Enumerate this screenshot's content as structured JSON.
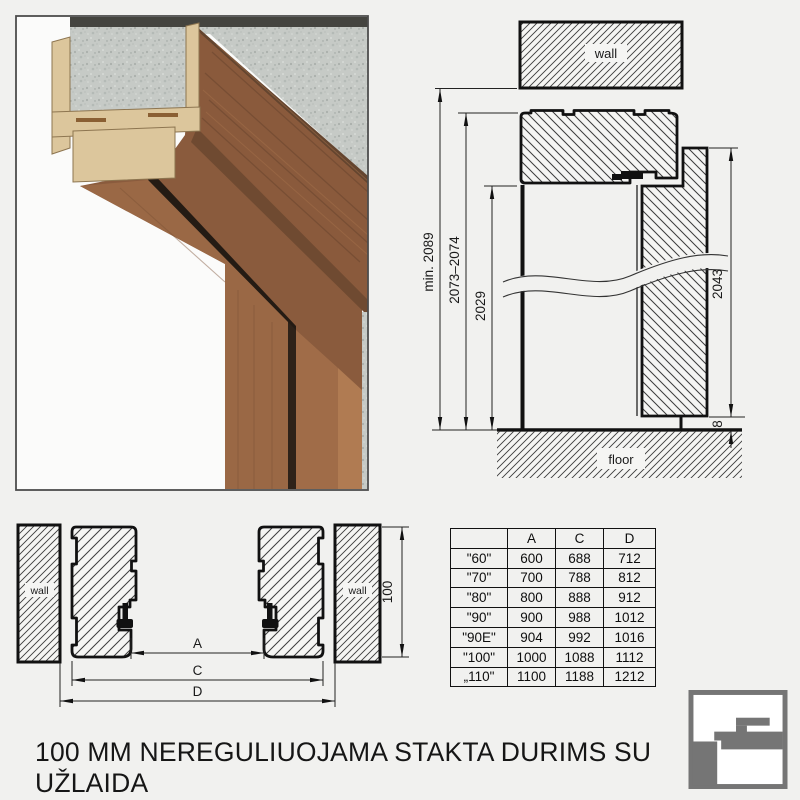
{
  "title": "100 MM NEREGULIUOJAMA STAKTA DURIMS SU UŽLAIDA",
  "vertical_section": {
    "wall_label": "wall",
    "floor_label": "floor",
    "dim_total": "min. 2089",
    "dim_frame": "2073–2074",
    "dim_opening": "2029",
    "dim_leaf": "2043",
    "dim_gap": "8"
  },
  "horizontal_section": {
    "wall_left": "wall",
    "wall_right": "wall",
    "dim_depth": "100",
    "dim_a": "A",
    "dim_c": "C",
    "dim_d": "D"
  },
  "table": {
    "headers": [
      "",
      "A",
      "C",
      "D"
    ],
    "rows": [
      [
        "\"60\"",
        "600",
        "688",
        "712"
      ],
      [
        "\"70\"",
        "700",
        "788",
        "812"
      ],
      [
        "\"80\"",
        "800",
        "888",
        "912"
      ],
      [
        "\"90\"",
        "900",
        "988",
        "1012"
      ],
      [
        "\"90E\"",
        "904",
        "992",
        "1016"
      ],
      [
        "\"100\"",
        "1000",
        "1088",
        "1112"
      ],
      [
        "„110\"",
        "1100",
        "1188",
        "1212"
      ]
    ]
  },
  "colors": {
    "background": "#f1f1ef",
    "line_art": "#111111",
    "wood_face": "#8a5a3c",
    "wood_dark": "#6f4a31",
    "mdf": "#dcc69c",
    "concrete": "#c6cac6",
    "seal_black": "#241b14",
    "logo_gray": "#757575"
  }
}
